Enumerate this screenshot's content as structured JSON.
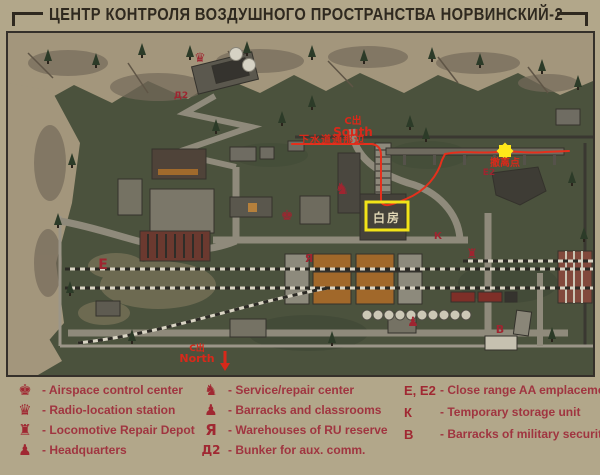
{
  "title": "ЦЕНТР КОНТРОЛЯ ВОЗДУШНОГО ПРОСТРАНСТВА НОРВИНСКИЙ-2",
  "colors": {
    "paper": "#b2a78a",
    "legend_red": "#a03540",
    "annotation_red": "#d8291a",
    "highlight_yellow": "#f2e318"
  },
  "map": {
    "labels": {
      "south_exit": {
        "line1": "C出",
        "line2": "South",
        "note": "下水道通那边"
      },
      "north_exit": {
        "line1": "C出",
        "line2": "North"
      },
      "extraction_note": "撤离点",
      "white_house": "白房",
      "markers": {
        "e": "E",
        "e2": "E2",
        "k": "К",
        "b": "B",
        "d2": "Д2"
      }
    },
    "icons": {
      "radio_location": "♛",
      "airspace": "♚",
      "service": "♞",
      "warehouses": "Я",
      "depot": "♜",
      "barracks": "♟"
    }
  },
  "legend": {
    "col1": [
      {
        "icon": "♚",
        "label": "- Airspace control center"
      },
      {
        "icon": "♛",
        "label": "- Radio-location station"
      },
      {
        "icon": "♜",
        "label": "- Locomotive Repair Depot"
      },
      {
        "icon": "♟",
        "label": "- Headquarters"
      }
    ],
    "col2": [
      {
        "icon": "♞",
        "label": "- Service/repair center"
      },
      {
        "icon": "♟",
        "label": "- Barracks and classrooms"
      },
      {
        "icon": "Я",
        "label": "- Warehouses of RU reserve"
      },
      {
        "icon": "Д2",
        "label": "- Bunker for aux. comm."
      }
    ],
    "col3": [
      {
        "letters": "E, E2",
        "label": "- Close range AA emplacement"
      },
      {
        "letters": "К",
        "label": "- Temporary storage unit"
      },
      {
        "letters": "B",
        "label": "- Barracks of military security team"
      }
    ]
  }
}
